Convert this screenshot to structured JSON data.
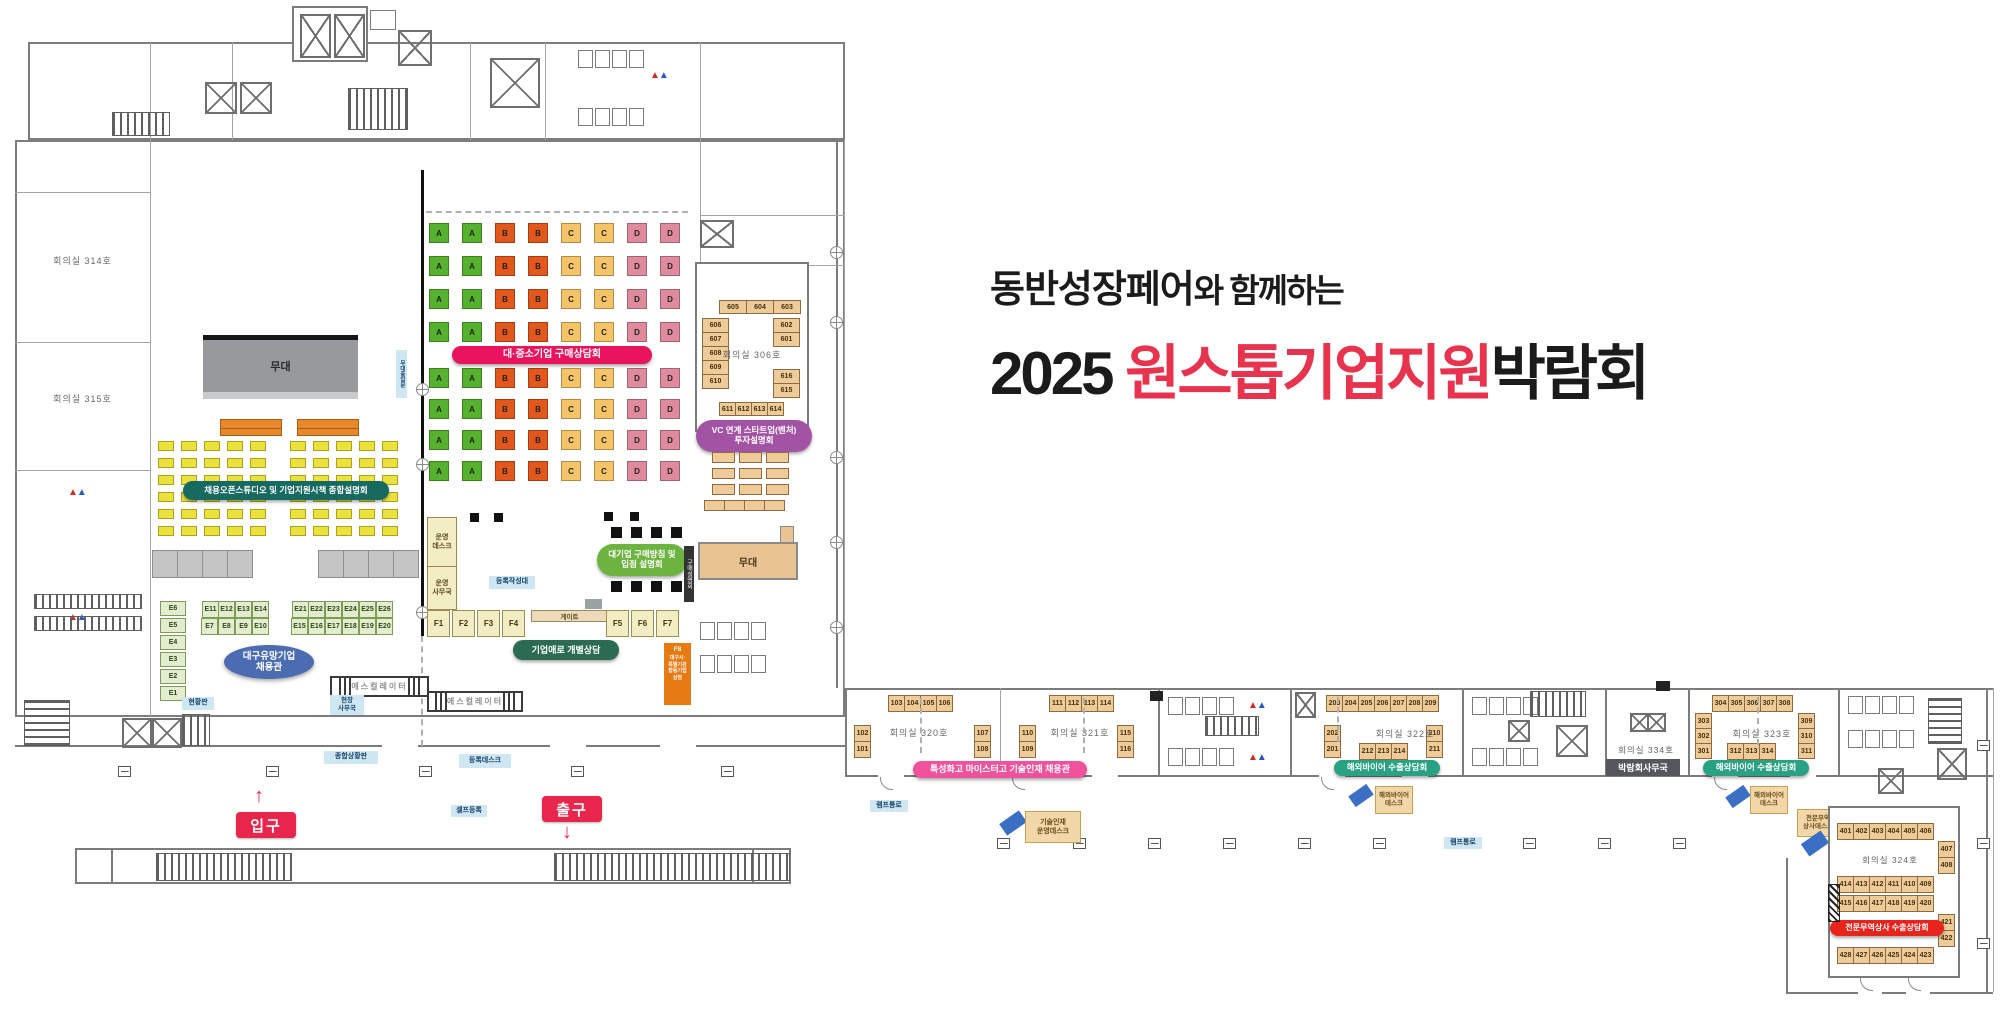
{
  "title": {
    "prefix_bold": "동반성장페어",
    "prefix_rest": "와 함께하는",
    "year": "2025 ",
    "highlight": "원스톱기업지원",
    "suffix": "박람회"
  },
  "halls": {
    "rooms": {
      "r314": "회의실 314호",
      "r315": "회의실 315호",
      "r306": "회의실 306호",
      "r320": "회의실 320호",
      "r321": "회의실 321호",
      "r322": "회의실 322호",
      "r323": "회의실 323호",
      "r324": "회의실 324호",
      "r334": "회의실 334호"
    },
    "stage_left": "무대",
    "stage_right": "무대"
  },
  "pills": {
    "purchase": "대·중소기업 구매상담회",
    "open_studio": "채용오픈스튜디오 및 기업지원시책 종합설명회",
    "vc": "VC 연계 스타트업(벤처)\n투자설명회",
    "large_purchase": "대기업 구매방침 및\n입점 설명회",
    "biz": "기업애로 개별상담",
    "daegu": "대구유망기업\n채용관",
    "tech": "특성화고 마이스터고 기술인재 채용관",
    "buyer1": "해외바이어 수출상담회",
    "buyer2": "해외바이어 수출상담회",
    "trade": "전문무역상사 수출상담회"
  },
  "labels": {
    "ops_desk": "운영\n데스크",
    "ops_office": "운영\n사무국",
    "reg_table": "등록작성대",
    "gate": "게이트",
    "board": "현황판",
    "site_office": "현장\n사무국",
    "escalator1": "에스컬레이터",
    "escalator2": "에스컬레이터",
    "status_board": "종합상황판",
    "reg_desk": "등록데스크",
    "self_reg": "셀프등록",
    "ramp1": "램프통로",
    "ramp2": "램프통로",
    "entrance": "입구",
    "exit": "출구",
    "buyer_desk1": "해외바이어\n데스크",
    "buyer_desk2": "해외바이어\n데스크",
    "tech_desk": "기술인재\n운영데스크",
    "trade_desk": "전문무역\n상사데스크",
    "expo_office": "박람회사무국",
    "purchase_briefing": "구매설명회",
    "stage_door": "무대출입문",
    "f8_id": "F8",
    "f8_text": "대구시·\n특별기관\n합동기업\n상담"
  },
  "icons": {
    "up_arrow": "↑",
    "down_arrow": "↓",
    "toilet_pair": "▲▲"
  },
  "booth_grid": {
    "columns": [
      "A",
      "A",
      "B",
      "B",
      "C",
      "C",
      "D",
      "D"
    ],
    "rows_top": 4,
    "rows_bottom": 4,
    "colors": {
      "A": "#55b12e",
      "B": "#e2571c",
      "C": "#f6c468",
      "D": "#e08a9d"
    }
  },
  "booths": {
    "e_col": [
      "E6",
      "E5",
      "E4",
      "E3",
      "E2",
      "E1"
    ],
    "e_block1": [
      "E11",
      "E12",
      "E13",
      "E14",
      "E7",
      "E8",
      "E9",
      "E10"
    ],
    "e_block2": [
      "E21",
      "E22",
      "E23",
      "E24",
      "E25",
      "E26",
      "E15",
      "E16",
      "E17",
      "E18",
      "E19",
      "E20"
    ],
    "f_left": [
      "F1",
      "F2",
      "F3",
      "F4"
    ],
    "f_right": [
      "F5",
      "F6",
      "F7"
    ],
    "r306_top": [
      "605",
      "604",
      "603"
    ],
    "r306_left": [
      "606",
      "607",
      "608",
      "609",
      "610"
    ],
    "r306_right_top": [
      "602",
      "601"
    ],
    "r306_right_bottom": [
      "616",
      "615"
    ],
    "r306_bottom": [
      "611",
      "612",
      "613",
      "614"
    ],
    "r320_top": [
      "103",
      "104",
      "105",
      "106"
    ],
    "r320_left": [
      "102",
      "101"
    ],
    "r320_right": [
      "107",
      "108"
    ],
    "r321_top": [
      "111",
      "112",
      "113",
      "114"
    ],
    "r321_left": [
      "110",
      "109"
    ],
    "r321_right": [
      "115",
      "116"
    ],
    "r322_top": [
      "203",
      "204",
      "205",
      "206",
      "207",
      "208",
      "209"
    ],
    "r322_left": [
      "202",
      "201"
    ],
    "r322_right": [
      "210",
      "211"
    ],
    "r322_bottom": [
      "212",
      "213",
      "214"
    ],
    "r323_top": [
      "304",
      "305",
      "306",
      "307",
      "308"
    ],
    "r323_left": [
      "303",
      "302",
      "301"
    ],
    "r323_right": [
      "309",
      "310",
      "311"
    ],
    "r323_bottom": [
      "312",
      "313",
      "314"
    ],
    "r324_row1": [
      "401",
      "402",
      "403",
      "404",
      "405",
      "406"
    ],
    "r324_right1": [
      "407",
      "408"
    ],
    "r324_row2": [
      "414",
      "413",
      "412",
      "411",
      "410",
      "409"
    ],
    "r324_row3": [
      "415",
      "416",
      "417",
      "418",
      "419",
      "420"
    ],
    "r324_right2": [
      "421",
      "422"
    ],
    "r324_row4": [
      "428",
      "427",
      "426",
      "425",
      "424",
      "423"
    ]
  },
  "counts": {
    "audience_block": 30,
    "gray_blocks": 4,
    "chair_row": 4,
    "table_grid306": 9,
    "bar306_cells": 4,
    "stall_row": 4
  },
  "colors": {
    "title_red": "#e8334f",
    "pill_purchase": "#e9135e",
    "pill_open_studio": "#176a60",
    "pill_vc": "#a353a3",
    "pill_large_purchase": "#6cb33f",
    "pill_biz": "#2a6b52",
    "pill_daegu": "#4b6cb0",
    "pill_tech": "#f0529b",
    "pill_buyer": "#2aa183",
    "pill_trade": "#e8231c",
    "entrance_exit": "#e8254b",
    "desk_blue": "#3a6fc4"
  }
}
